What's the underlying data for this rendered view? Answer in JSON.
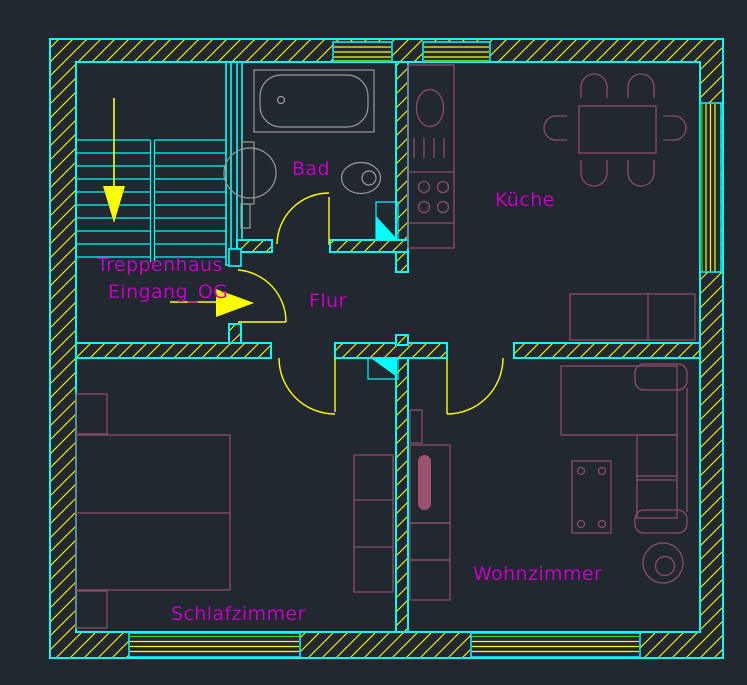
{
  "canvas": {
    "type": "cad-floor-plan-view",
    "background": "#212830"
  },
  "colors": {
    "background": "#212830",
    "walls_cyan": "#00ffff",
    "hatch_yellow": "#ffff00",
    "door_swing_yellow": "#ffff00",
    "window_line_yellow": "#ffff00",
    "window_line_green": "#44dd00",
    "room_label_magenta": "#c400c4",
    "furniture_mauve": "#8f4c66",
    "sanitary_gray": "#9b9b9b"
  },
  "labels": {
    "stairwell": "Treppenhaus",
    "entrance": "Eingang_OG",
    "bathroom": "Bad",
    "kitchen": "Küche",
    "hallway": "Flur",
    "bedroom": "Schlafzimmer",
    "living_room": "Wohnzimmer"
  },
  "symbols": {
    "arrows": [
      "stair-down-arrow",
      "entrance-direction-arrow"
    ],
    "doors": [
      "bathroom-door-swing",
      "entrance-door-swing",
      "bedroom-door-swing",
      "living-room-door-swing"
    ],
    "windows": [
      "bath-window-top",
      "kitchen-window-top",
      "kitchen-window-right",
      "bedroom-window-bottom",
      "living-room-window-bottom"
    ],
    "fixtures": [
      "bathtub",
      "wash-basin",
      "toilet",
      "kitchen-counter",
      "kitchen-sink",
      "stove-burners",
      "dining-table",
      "dining-chairs",
      "sideboard",
      "double-bed",
      "nightstands",
      "wardrobe",
      "corner-sofa",
      "coffee-table",
      "plant",
      "tv-board"
    ]
  }
}
